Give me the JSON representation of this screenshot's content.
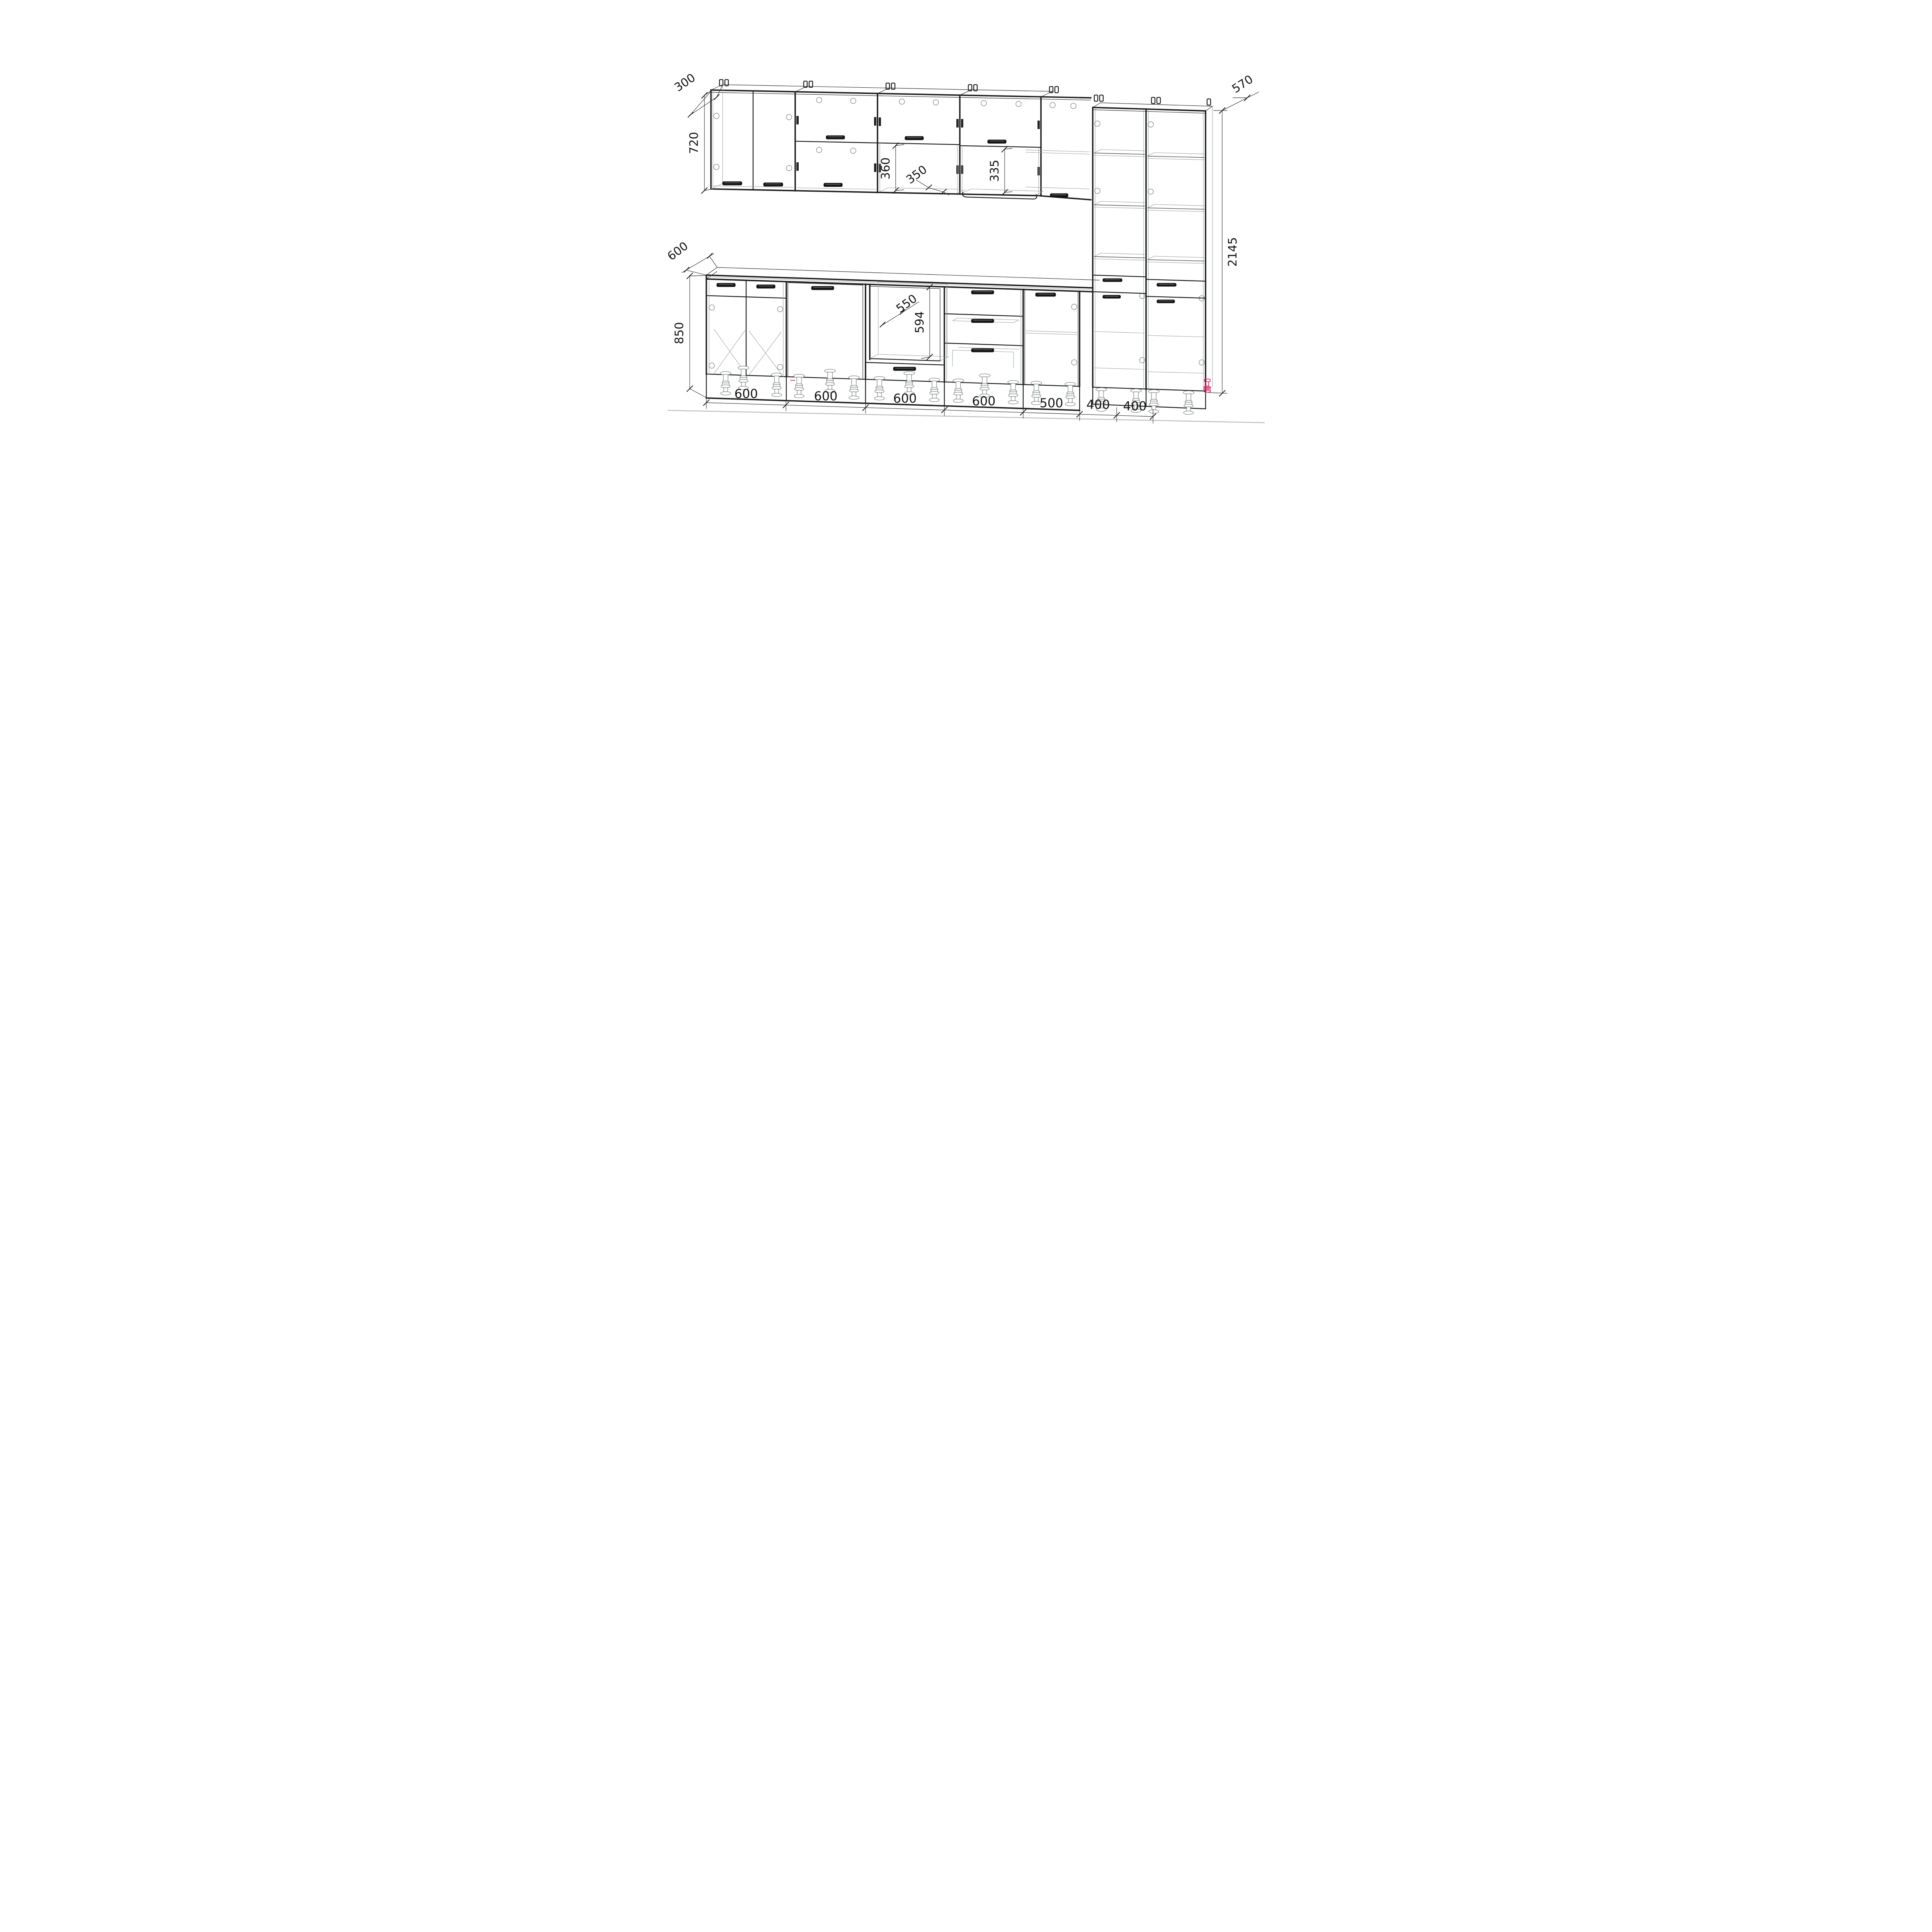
{
  "drawing": {
    "kind": "kitchen-cabinet-set-technical-drawing",
    "units": "mm",
    "colors": {
      "line": "#1d1d1d",
      "wireframe": "#98a1a1",
      "accent": "#e8316b",
      "floor_line": "#b9c0c0",
      "background": "#ffffff"
    },
    "dimensions": {
      "wall_cabinet_depth": "300",
      "wall_cabinet_height": "720",
      "wall_open_section_height": "360",
      "wall_shelf_depth": "350",
      "wall_niche_height": "335",
      "tall_cabinet_depth": "570",
      "tall_cabinet_height": "2145",
      "countertop_depth": "600",
      "base_cabinet_height": "850",
      "oven_niche_width": "550",
      "oven_niche_height": "594",
      "cabinet_widths": [
        "600",
        "600",
        "600",
        "600",
        "500",
        "400",
        "400"
      ]
    }
  }
}
